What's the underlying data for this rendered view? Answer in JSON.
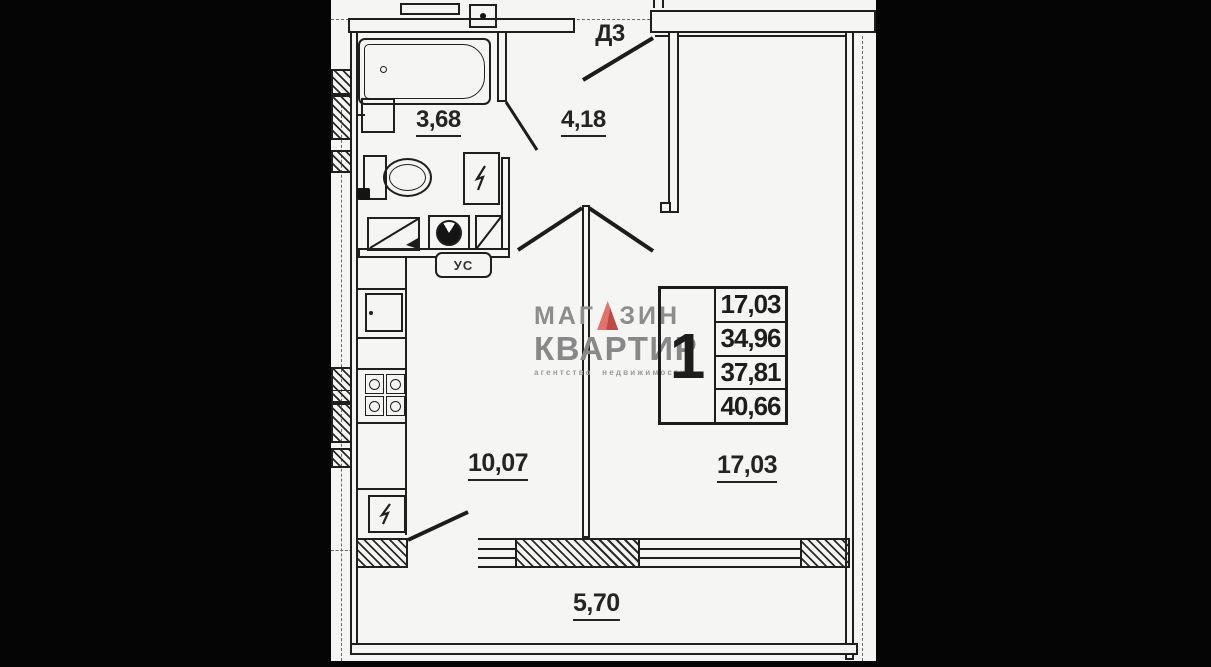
{
  "title": "Floor plan scan — one-room apartment",
  "colors": {
    "line": "#1f1f1f",
    "paper": "#f5f5f3",
    "matte_bars": "#050505",
    "watermark_text": "#8a8a8a",
    "logo_red": "#cf544e"
  },
  "labels": {
    "door": "Д3",
    "bathroom_area": "3,68",
    "hallway_area": "4,18",
    "kitchen_area": "10,07",
    "room_area": "17,03",
    "balcony_area": "5,70",
    "utility_tag": "УС"
  },
  "stamp": {
    "rooms_count": "1",
    "values": [
      "17,03",
      "34,96",
      "37,81",
      "40,66"
    ]
  },
  "watermark": {
    "line1_left": "МАГ",
    "line1_right": "ЗИН",
    "line2": "КВАРТИР",
    "line3": "агентство недвижимости"
  },
  "icons": {
    "logo_triangle": "red-triangle-as-letter-A",
    "lightning": "zigzag-bolt-glyph",
    "bathtub": "rounded-rect-with-drain-dot",
    "toilet": "tank-plus-oval-bowl",
    "stove": "four-burner-grid",
    "washing_machine": "square-with-round-door"
  }
}
